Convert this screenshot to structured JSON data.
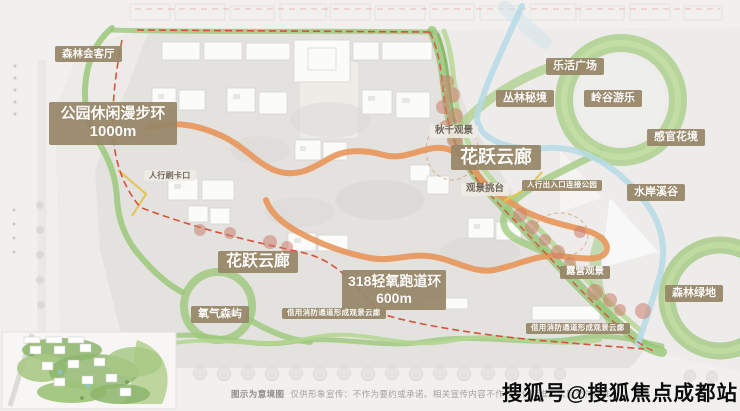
{
  "labels": {
    "forest_lounge": "森林会客厅",
    "park_loop_1": "公园休闲漫步环",
    "park_loop_2": "1000m",
    "ped_gate": "人行刷卡口",
    "swing_view": "秋千观景",
    "flower_corridor_right": "花跃云廊",
    "view_deck": "观景挑台",
    "ped_entrance": "人行出入口连接公园",
    "lohas_plaza": "乐活广场",
    "jungle_secret": "丛林秘境",
    "valley_play": "岭谷游乐",
    "sensory_garden": "感官花境",
    "waterfront_valley": "水岸溪谷",
    "flower_corridor_bottom": "花跃云廊",
    "track_1": "318轻氧跑道环",
    "track_2": "600m",
    "oxygen_forest": "氧气森屿",
    "fire_lane_note_1": "借用消防通道形成观景云廊",
    "fire_lane_note_2": "借用消防通道形成观景云廊",
    "camping_view": "露营观景",
    "forest_green": "森林绿地"
  },
  "footer": {
    "intro": "图示为意境图",
    "disclaimer": "仅供形象宣传：不作为要约或承诺。相关宣传内容不作为交付标准，实际交付标准"
  },
  "watermark": "搜狐号@搜狐焦点成都站",
  "colors": {
    "label_tan": "#978567",
    "green_path": "#9cc87a",
    "green_ring": "#a5cc85",
    "orange_track": "#e8965a",
    "stream_blue": "#b5dbe6",
    "boundary_red": "#d84a35",
    "tree_coral": "#cd7f6d",
    "watermark_black": "#0c0c0c"
  }
}
